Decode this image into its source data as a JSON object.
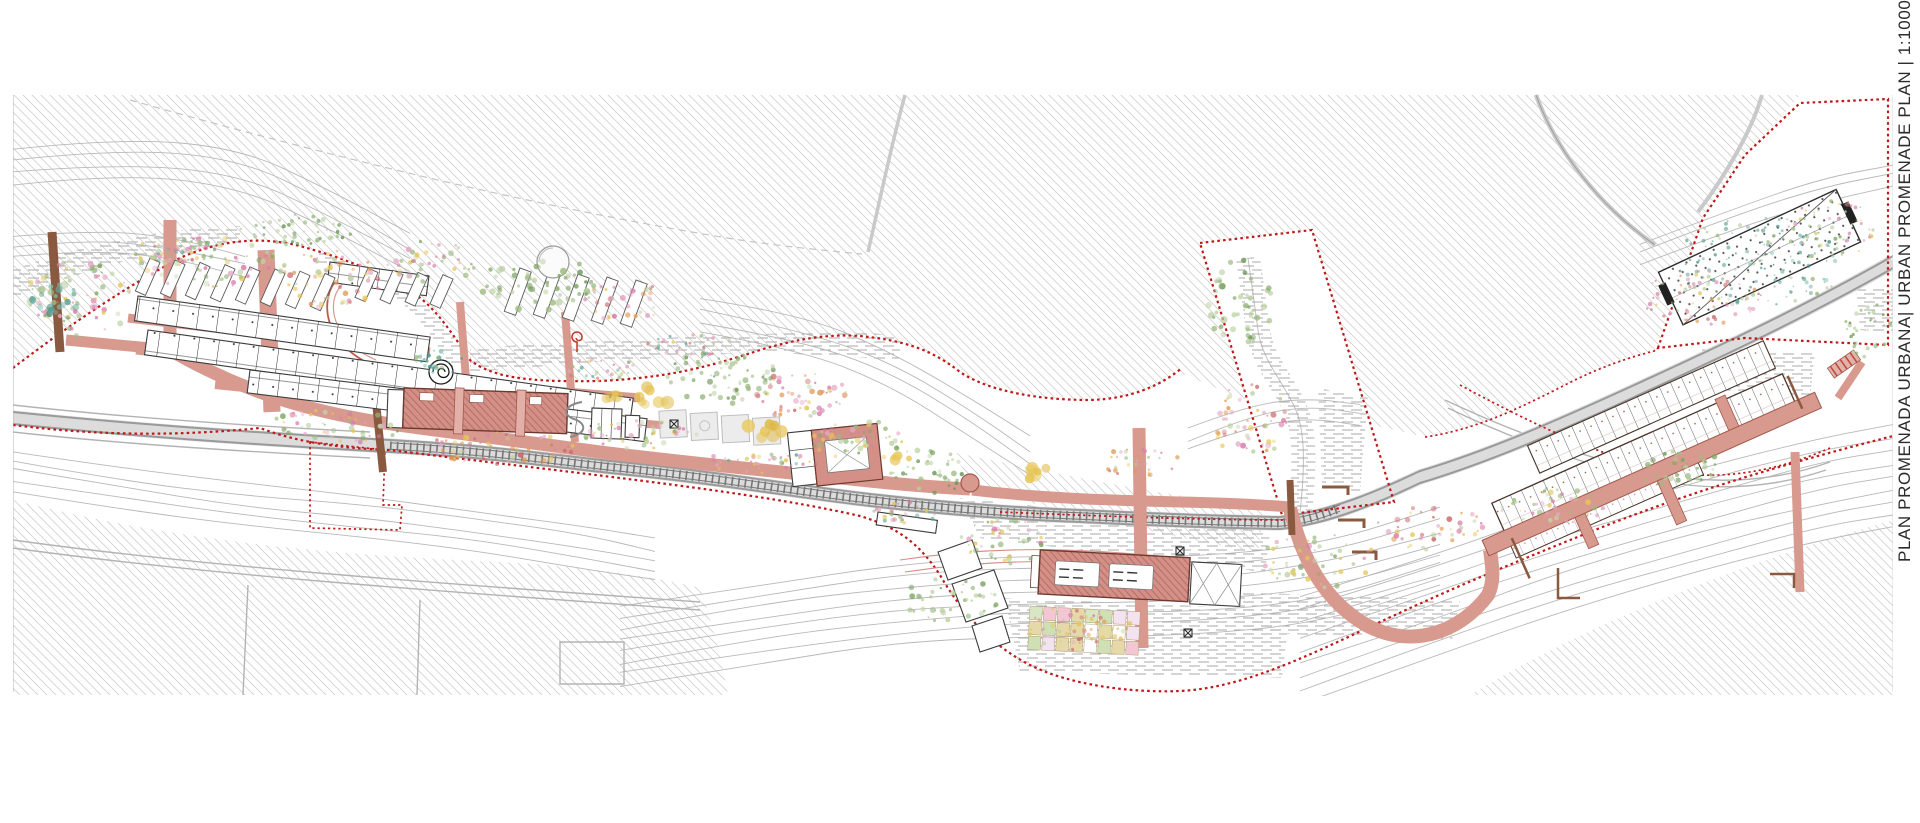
{
  "title_block": {
    "text": "PLAN PROMENADA URBANA| URBAN PROMENADE PLAN | 1:1000",
    "name_ro": "PLAN PROMENADA URBANA",
    "name_en": "URBAN PROMENADE PLAN",
    "scale": "1:1000"
  },
  "colors": {
    "paper": "#ffffff",
    "boundary_red": "#c01818",
    "promenade_pink": "#d89a8f",
    "building_pink": "#cf8d83",
    "building_outline": "#6d3a2f",
    "hatch_gray": "#d2d2d2",
    "contour_gray": "#b8b8b8",
    "road_gray": "#9a9a9a",
    "rail_dark": "#4a4a4a",
    "wood_brown": "#8a5a40"
  },
  "decor": {
    "seed": 7,
    "tree_palettes": {
      "green": [
        "#9dbb80",
        "#7fa763",
        "#b8cf9d",
        "#6d9655"
      ],
      "mixed": [
        "#9dbb80",
        "#e3a7c4",
        "#e6c556",
        "#7fa763",
        "#d87ba8",
        "#c2d6a8"
      ],
      "flower": [
        "#e3a7c4",
        "#d87ba8",
        "#e6c556",
        "#e0964f",
        "#cc6b6b",
        "#b8cf9d"
      ],
      "teal": [
        "#63a89a",
        "#7fbfae",
        "#9dbb80",
        "#4f9487"
      ],
      "speck": [
        "#cc6b6b",
        "#e3a7c4",
        "#e6c556",
        "#63a89a",
        "#9dbb80",
        "#d87ba8"
      ],
      "yellow": [
        "#e8c95e",
        "#dfb84a",
        "#e6c556"
      ]
    },
    "tree_clusters": [
      {
        "cx": 80,
        "cy": 300,
        "rx": 55,
        "ry": 40,
        "n": 70,
        "rmin": 1,
        "rmax": 3,
        "p": "mixed"
      },
      {
        "cx": 210,
        "cy": 263,
        "rx": 70,
        "ry": 26,
        "n": 80,
        "rmin": 1,
        "rmax": 3,
        "p": "mixed"
      },
      {
        "cx": 330,
        "cy": 280,
        "rx": 55,
        "ry": 30,
        "n": 60,
        "rmin": 1,
        "rmax": 3,
        "p": "flower"
      },
      {
        "cx": 300,
        "cy": 230,
        "rx": 60,
        "ry": 16,
        "n": 50,
        "rmin": 1,
        "rmax": 2.5,
        "p": "green"
      },
      {
        "cx": 430,
        "cy": 263,
        "rx": 45,
        "ry": 22,
        "n": 45,
        "rmin": 1,
        "rmax": 3,
        "p": "mixed"
      },
      {
        "cx": 540,
        "cy": 285,
        "rx": 60,
        "ry": 28,
        "n": 55,
        "rmin": 1.5,
        "rmax": 3.5,
        "p": "green"
      },
      {
        "cx": 625,
        "cy": 300,
        "rx": 40,
        "ry": 22,
        "n": 40,
        "rmin": 1,
        "rmax": 3,
        "p": "flower"
      },
      {
        "cx": 330,
        "cy": 428,
        "rx": 70,
        "ry": 18,
        "n": 55,
        "rmin": 1,
        "rmax": 3,
        "p": "mixed"
      },
      {
        "cx": 500,
        "cy": 448,
        "rx": 80,
        "ry": 16,
        "n": 60,
        "rmin": 1,
        "rmax": 3,
        "p": "flower"
      },
      {
        "cx": 640,
        "cy": 435,
        "rx": 60,
        "ry": 15,
        "n": 50,
        "rmin": 1,
        "rmax": 3,
        "p": "mixed"
      },
      {
        "cx": 720,
        "cy": 378,
        "rx": 60,
        "ry": 26,
        "n": 70,
        "rmin": 1,
        "rmax": 3,
        "p": "green"
      },
      {
        "cx": 800,
        "cy": 395,
        "rx": 50,
        "ry": 24,
        "n": 55,
        "rmin": 1,
        "rmax": 3,
        "p": "flower"
      },
      {
        "cx": 860,
        "cy": 440,
        "rx": 50,
        "ry": 20,
        "n": 50,
        "rmin": 1,
        "rmax": 3,
        "p": "mixed"
      },
      {
        "cx": 760,
        "cy": 463,
        "rx": 60,
        "ry": 11,
        "n": 40,
        "rmin": 1,
        "rmax": 2.5,
        "p": "speck"
      },
      {
        "cx": 930,
        "cy": 470,
        "rx": 40,
        "ry": 24,
        "n": 40,
        "rmin": 1,
        "rmax": 3,
        "p": "green"
      },
      {
        "cx": 1000,
        "cy": 540,
        "rx": 45,
        "ry": 28,
        "n": 45,
        "rmin": 1,
        "rmax": 3,
        "p": "mixed"
      },
      {
        "cx": 950,
        "cy": 598,
        "rx": 50,
        "ry": 24,
        "n": 40,
        "rmin": 1,
        "rmax": 3,
        "p": "green"
      },
      {
        "cx": 1075,
        "cy": 628,
        "rx": 58,
        "ry": 22,
        "n": 50,
        "rmin": 1,
        "rmax": 2.5,
        "p": "flower"
      },
      {
        "cx": 1240,
        "cy": 300,
        "rx": 34,
        "ry": 45,
        "n": 45,
        "rmin": 1.5,
        "rmax": 3.5,
        "p": "green"
      },
      {
        "cx": 1250,
        "cy": 420,
        "rx": 38,
        "ry": 38,
        "n": 50,
        "rmin": 1,
        "rmax": 3,
        "p": "flower"
      },
      {
        "cx": 1320,
        "cy": 560,
        "rx": 58,
        "ry": 28,
        "n": 50,
        "rmin": 1,
        "rmax": 3,
        "p": "mixed"
      },
      {
        "cx": 1430,
        "cy": 528,
        "rx": 55,
        "ry": 24,
        "n": 45,
        "rmin": 1,
        "rmax": 3,
        "p": "flower"
      },
      {
        "cx": 1555,
        "cy": 508,
        "rx": 55,
        "ry": 20,
        "n": 45,
        "rmin": 1,
        "rmax": 3,
        "p": "mixed"
      },
      {
        "cx": 1680,
        "cy": 468,
        "rx": 45,
        "ry": 18,
        "n": 40,
        "rmin": 1,
        "rmax": 3,
        "p": "green"
      },
      {
        "cx": 1760,
        "cy": 262,
        "rx": 85,
        "ry": 45,
        "n": 140,
        "rmin": 0.8,
        "rmax": 2.2,
        "p": "teal"
      },
      {
        "cx": 1702,
        "cy": 298,
        "rx": 60,
        "ry": 28,
        "n": 70,
        "rmin": 0.8,
        "rmax": 2.2,
        "p": "flower"
      },
      {
        "cx": 1832,
        "cy": 228,
        "rx": 48,
        "ry": 28,
        "n": 60,
        "rmin": 0.8,
        "rmax": 2.2,
        "p": "mixed"
      },
      {
        "cx": 440,
        "cy": 360,
        "rx": 30,
        "ry": 14,
        "n": 25,
        "rmin": 1,
        "rmax": 2.5,
        "p": "teal"
      },
      {
        "cx": 600,
        "cy": 370,
        "rx": 40,
        "ry": 13,
        "n": 30,
        "rmin": 1,
        "rmax": 2,
        "p": "speck"
      },
      {
        "cx": 905,
        "cy": 513,
        "rx": 35,
        "ry": 11,
        "n": 30,
        "rmin": 1,
        "rmax": 2.5,
        "p": "speck"
      },
      {
        "cx": 1140,
        "cy": 462,
        "rx": 40,
        "ry": 14,
        "n": 30,
        "rmin": 1,
        "rmax": 2.5,
        "p": "flower"
      },
      {
        "cx": 55,
        "cy": 300,
        "rx": 25,
        "ry": 20,
        "n": 25,
        "rmin": 2,
        "rmax": 4,
        "p": "teal"
      },
      {
        "cx": 1868,
        "cy": 330,
        "rx": 24,
        "ry": 28,
        "n": 30,
        "rmin": 1,
        "rmax": 2.5,
        "p": "green"
      },
      {
        "cx": 170,
        "cy": 250,
        "rx": 40,
        "ry": 13,
        "n": 30,
        "rmin": 1,
        "rmax": 2.5,
        "p": "speck"
      },
      {
        "cx": 690,
        "cy": 345,
        "rx": 45,
        "ry": 11,
        "n": 30,
        "rmin": 1,
        "rmax": 2,
        "p": "speck"
      },
      {
        "cx": 655,
        "cy": 395,
        "rx": 20,
        "ry": 11,
        "n": 8,
        "rmin": 4,
        "rmax": 7,
        "p": "yellow"
      },
      {
        "cx": 760,
        "cy": 430,
        "rx": 24,
        "ry": 9,
        "n": 8,
        "rmin": 4,
        "rmax": 7,
        "p": "yellow"
      },
      {
        "cx": 1035,
        "cy": 470,
        "rx": 18,
        "ry": 9,
        "n": 6,
        "rmin": 4,
        "rmax": 7,
        "p": "yellow"
      },
      {
        "cx": 905,
        "cy": 455,
        "rx": 14,
        "ry": 8,
        "n": 5,
        "rmin": 3,
        "rmax": 6,
        "p": "yellow"
      },
      {
        "cx": 608,
        "cy": 392,
        "rx": 12,
        "ry": 8,
        "n": 5,
        "rmin": 3,
        "rmax": 6,
        "p": "yellow"
      }
    ],
    "contour_groups": [
      {
        "pts": [
          [
            13,
            148
          ],
          [
            120,
            136
          ],
          [
            240,
            148
          ],
          [
            330,
            188
          ],
          [
            410,
            235
          ]
        ],
        "copies": 4,
        "gap": 13
      },
      {
        "pts": [
          [
            13,
            450
          ],
          [
            120,
            468
          ],
          [
            240,
            484
          ],
          [
            360,
            496
          ],
          [
            470,
            510
          ],
          [
            580,
            526
          ],
          [
            655,
            540
          ]
        ],
        "copies": 5,
        "gap": 10
      },
      {
        "pts": [
          [
            620,
            608
          ],
          [
            760,
            584
          ],
          [
            900,
            565
          ],
          [
            1040,
            557
          ],
          [
            1180,
            559
          ],
          [
            1320,
            544
          ],
          [
            1440,
            509
          ]
        ],
        "copies": 8,
        "gap": 11
      },
      {
        "pts": [
          [
            1300,
            598
          ],
          [
            1420,
            558
          ],
          [
            1560,
            508
          ],
          [
            1700,
            468
          ],
          [
            1820,
            438
          ],
          [
            1893,
            424
          ]
        ],
        "copies": 9,
        "gap": 13
      },
      {
        "pts": [
          [
            700,
            298
          ],
          [
            800,
            316
          ],
          [
            890,
            350
          ],
          [
            970,
            398
          ],
          [
            1030,
            438
          ]
        ],
        "copies": 4,
        "gap": 12
      },
      {
        "pts": [
          [
            1640,
            243
          ],
          [
            1730,
            208
          ],
          [
            1820,
            178
          ],
          [
            1893,
            163
          ]
        ],
        "copies": 3,
        "gap": 11
      },
      {
        "pts": [
          [
            1188,
            428
          ],
          [
            1250,
            406
          ],
          [
            1310,
            396
          ],
          [
            1360,
            403
          ]
        ],
        "copies": 3,
        "gap": 11
      },
      {
        "pts": [
          [
            13,
            236
          ],
          [
            90,
            228
          ],
          [
            170,
            236
          ],
          [
            245,
            256
          ]
        ],
        "copies": 3,
        "gap": 10
      }
    ],
    "slanted_rows": [
      {
        "x": 150,
        "y": 258,
        "dx": 25,
        "dy": 2.2,
        "count": 8,
        "w": 11,
        "h": 36,
        "angle": 24
      },
      {
        "x": 368,
        "y": 268,
        "dx": 25,
        "dy": 2.2,
        "count": 4,
        "w": 11,
        "h": 32,
        "angle": 24
      },
      {
        "x": 520,
        "y": 268,
        "dx": 29,
        "dy": 3,
        "count": 5,
        "w": 12,
        "h": 46,
        "angle": 20
      }
    ],
    "garden": {
      "x": 1030,
      "y": 606,
      "cols": 8,
      "rows": 3,
      "cw": 14,
      "ch": 15,
      "angle": 3,
      "palette": [
        "#f2c6d2",
        "#e6d9a8",
        "#cfe0b5",
        "#ffffff",
        "#f3e2ef",
        "#d9e6c3"
      ]
    }
  }
}
